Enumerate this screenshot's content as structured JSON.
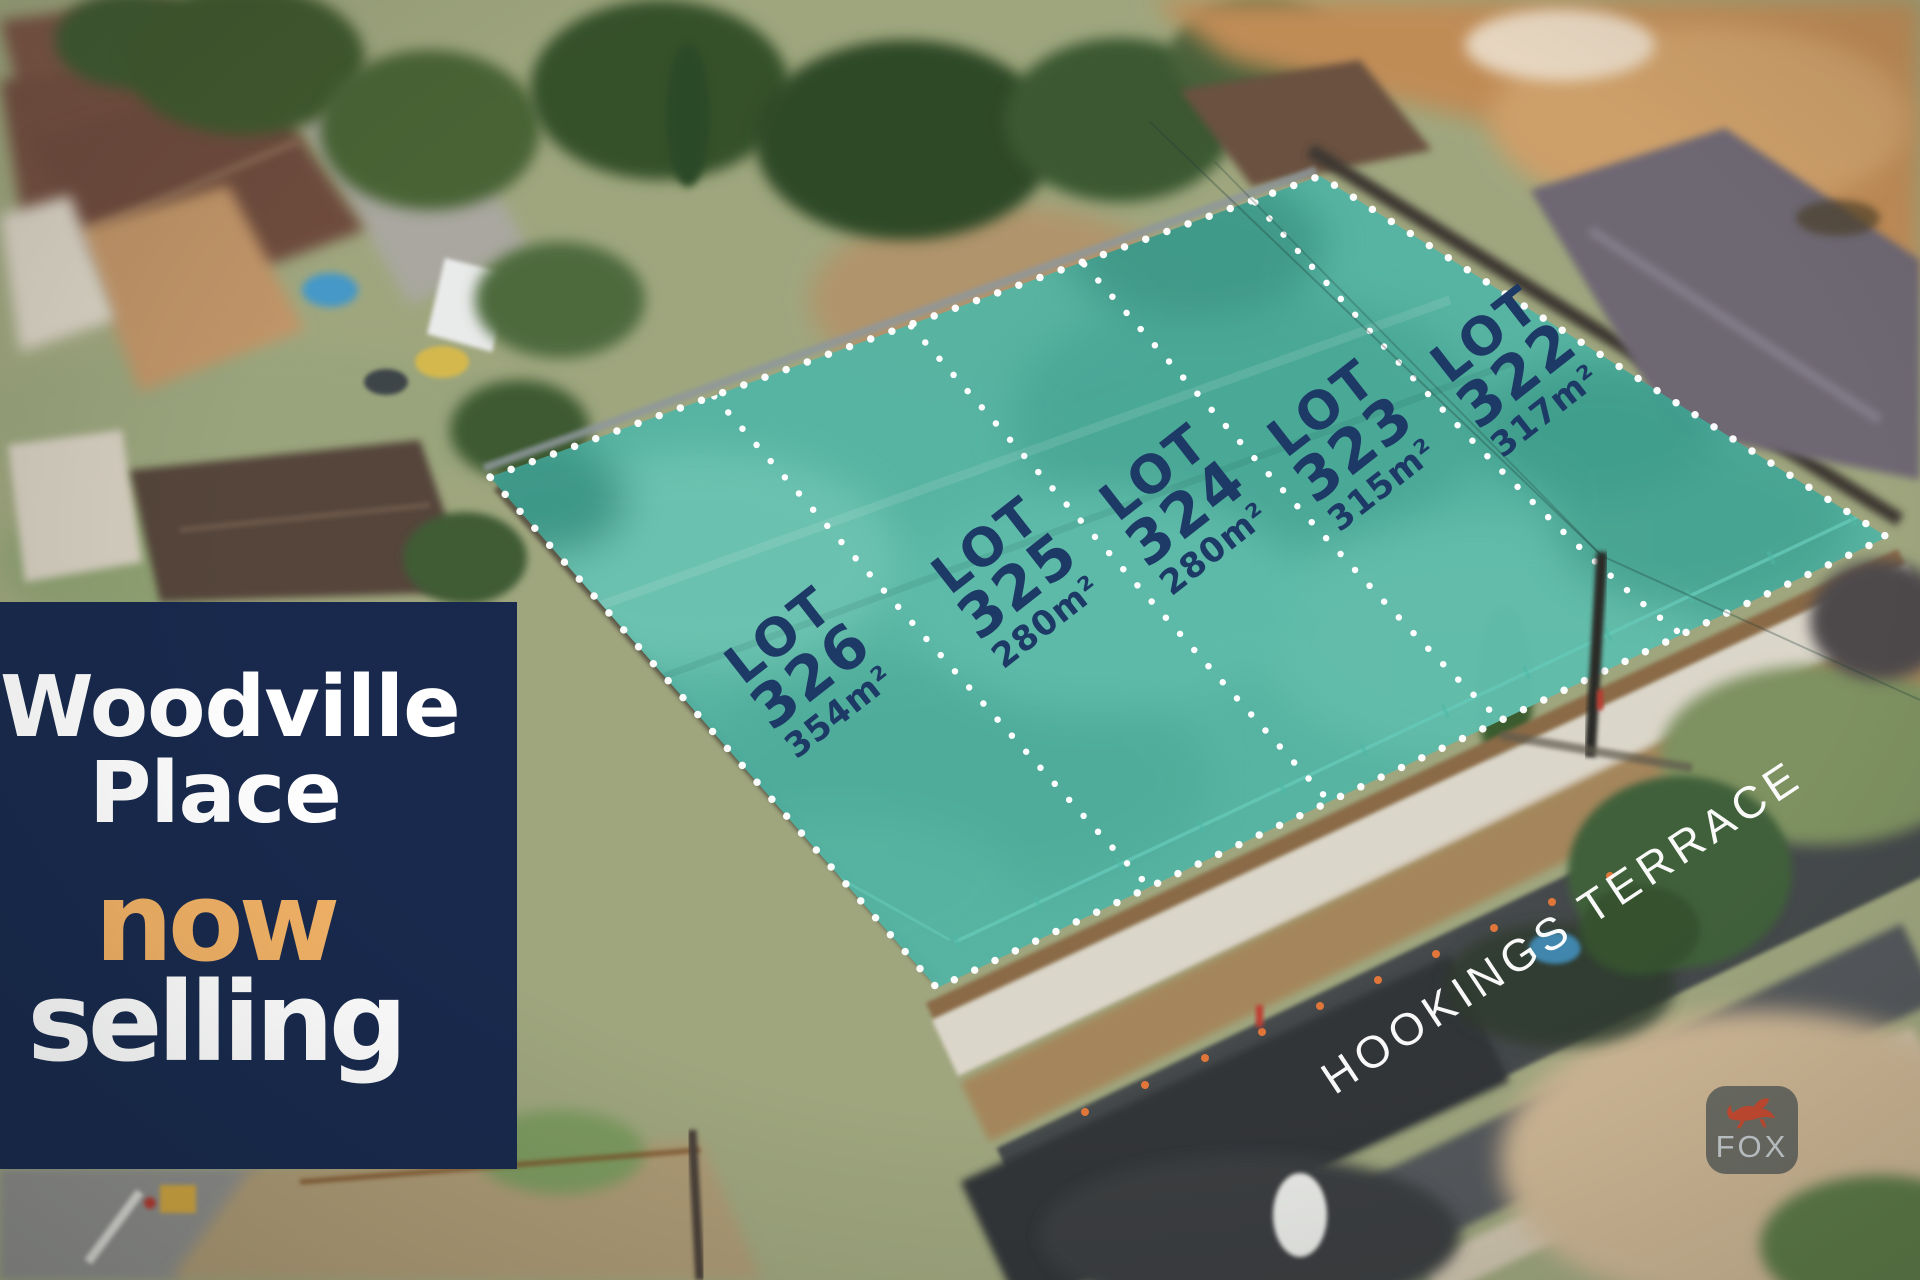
{
  "banner": {
    "brand_line1": "Woodville",
    "brand_line2": "Place",
    "status_line1": "now",
    "status_line2": "selling",
    "bg_color": "#18294d",
    "accent_color": "#f2b266"
  },
  "lots": [
    {
      "label": "LOT",
      "number": "326",
      "area": "354m²"
    },
    {
      "label": "LOT",
      "number": "325",
      "area": "280m²"
    },
    {
      "label": "LOT",
      "number": "324",
      "area": "280m²"
    },
    {
      "label": "LOT",
      "number": "323",
      "area": "315m²"
    },
    {
      "label": "LOT",
      "number": "322",
      "area": "317m²"
    }
  ],
  "street": {
    "label": "HOOKINGS TERRACE"
  },
  "watermark": {
    "text": "FOX",
    "icon": "fox-icon"
  },
  "overlay": {
    "parcel_fill": "#54b4a4",
    "lot_text_color": "#1d3966",
    "boundary_dot_color": "#ffffff"
  }
}
